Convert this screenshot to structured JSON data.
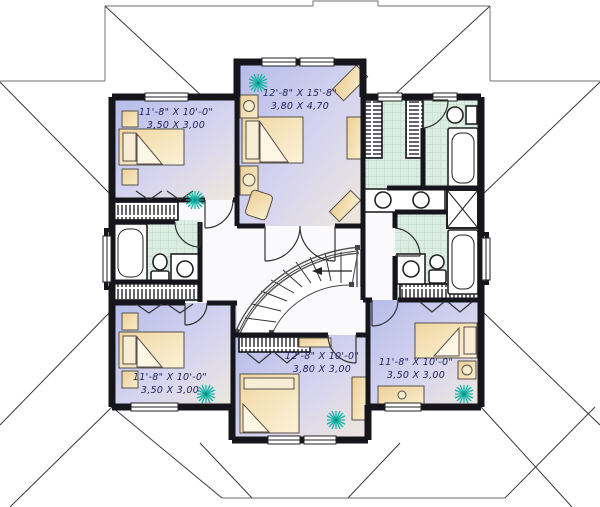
{
  "plan": {
    "type": "second-floor-plan",
    "rooms": [
      {
        "id": "master-bedroom-top-center",
        "imperial": "12'-8\" X 15'-8\"",
        "metric": "3,80 X 4,70"
      },
      {
        "id": "bedroom-top-left",
        "imperial": "11'-8\" X 10'-0\"",
        "metric": "3,50 X 3,00"
      },
      {
        "id": "bedroom-bottom-left",
        "imperial": "11'-8\" X 10'-0\"",
        "metric": "3,50 X 3,00"
      },
      {
        "id": "bedroom-bottom-center",
        "imperial": "12'-8\" X 10'-0\"",
        "metric": "3,80 X 3,00"
      },
      {
        "id": "bedroom-bottom-right",
        "imperial": "11'-8\" X 10'-0\"",
        "metric": "3,50 X 3,00"
      }
    ],
    "features": [
      "curved-staircase",
      "three-bathrooms",
      "walk-in-closet",
      "double-sink-vanity"
    ],
    "colors": {
      "wall": "#15151b",
      "bedroom_floor_start": "#b4bce9",
      "bedroom_floor_end": "#efe8dc",
      "bath_tile": "#dcede4",
      "furniture": "#f2dca6",
      "plant": "#14b3a4",
      "label_text": "#23235e",
      "roof_line": "#8a8a8a"
    }
  }
}
